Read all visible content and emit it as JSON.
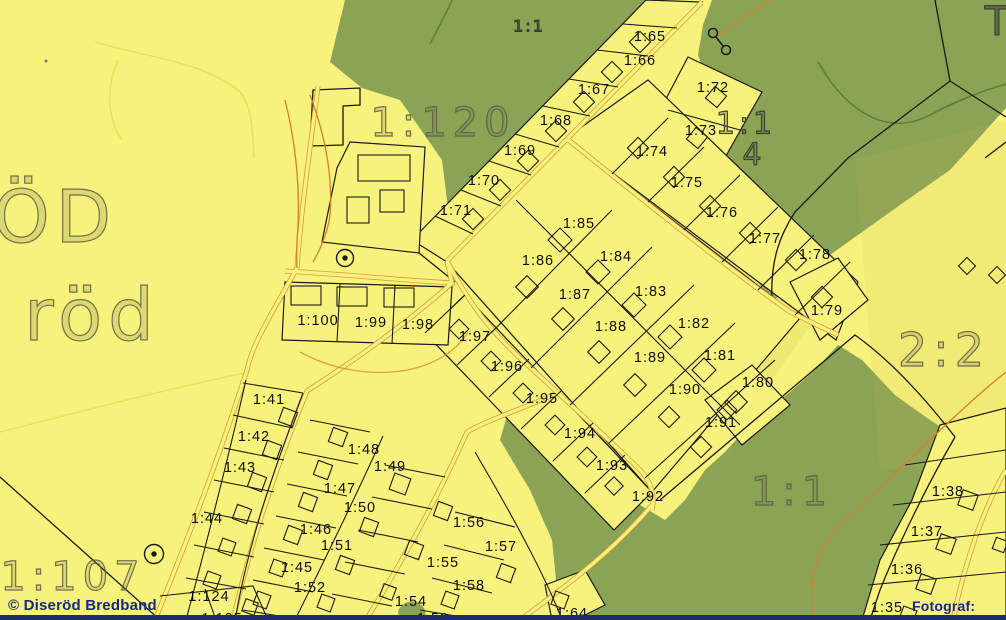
{
  "map": {
    "watermark": "© Diseröd Bredband",
    "credit": "Fotograf: DWG",
    "colors": {
      "background_yellow": "#f7f27b",
      "forest_green": "#8ba355",
      "road_orange": "#d89a3c",
      "contour_orange": "#d97e2e",
      "boundary_ink": "#1a1a1a",
      "big_label_gray": "#6f6f5a",
      "watermark_navy": "#16278f"
    },
    "area_labels": [
      {
        "text": "ÖD",
        "x": 55,
        "y": 217,
        "size": 72,
        "cls": "outline"
      },
      {
        "text": "röd",
        "x": 92,
        "y": 315,
        "size": 72,
        "cls": "outline"
      },
      {
        "text": "1:120",
        "x": 443,
        "y": 123,
        "size": 40,
        "cls": "outline"
      },
      {
        "text": "1:107",
        "x": 73,
        "y": 577,
        "size": 40,
        "cls": "outline"
      },
      {
        "text": "2:2",
        "x": 944,
        "y": 350,
        "size": 46,
        "cls": "outline"
      },
      {
        "text": "1:1",
        "x": 792,
        "y": 492,
        "size": 40,
        "cls": "outline"
      },
      {
        "text": "1:1",
        "x": 529,
        "y": 26,
        "size": 16,
        "cls": "dark"
      },
      {
        "text": "1:1",
        "x": 746,
        "y": 124,
        "size": 30,
        "cls": "outline-dark"
      },
      {
        "text": "4",
        "x": 754,
        "y": 155,
        "size": 30,
        "cls": "outline-dark"
      },
      {
        "text": "T",
        "x": 998,
        "y": 22,
        "size": 40,
        "cls": "dark"
      }
    ],
    "parcel_labels": [
      {
        "text": "1:65",
        "x": 650,
        "y": 37
      },
      {
        "text": "1:66",
        "x": 640,
        "y": 61
      },
      {
        "text": "1:67",
        "x": 594,
        "y": 90
      },
      {
        "text": "1:68",
        "x": 556,
        "y": 121
      },
      {
        "text": "1:69",
        "x": 520,
        "y": 151
      },
      {
        "text": "1:70",
        "x": 484,
        "y": 181
      },
      {
        "text": "1:71",
        "x": 456,
        "y": 211
      },
      {
        "text": "1:72",
        "x": 713,
        "y": 88
      },
      {
        "text": "1:73",
        "x": 701,
        "y": 131
      },
      {
        "text": "1:74",
        "x": 652,
        "y": 152
      },
      {
        "text": "1:75",
        "x": 687,
        "y": 183
      },
      {
        "text": "1:76",
        "x": 722,
        "y": 213
      },
      {
        "text": "1:77",
        "x": 765,
        "y": 239
      },
      {
        "text": "1:78",
        "x": 815,
        "y": 255
      },
      {
        "text": "1:79",
        "x": 827,
        "y": 311
      },
      {
        "text": "1:85",
        "x": 579,
        "y": 224
      },
      {
        "text": "1:84",
        "x": 616,
        "y": 257
      },
      {
        "text": "1:83",
        "x": 651,
        "y": 292
      },
      {
        "text": "1:82",
        "x": 694,
        "y": 324
      },
      {
        "text": "1:81",
        "x": 720,
        "y": 356
      },
      {
        "text": "1:86",
        "x": 538,
        "y": 261
      },
      {
        "text": "1:87",
        "x": 575,
        "y": 295
      },
      {
        "text": "1:88",
        "x": 611,
        "y": 327
      },
      {
        "text": "1:89",
        "x": 650,
        "y": 358
      },
      {
        "text": "1:90",
        "x": 685,
        "y": 390
      },
      {
        "text": "1:91",
        "x": 721,
        "y": 423
      },
      {
        "text": "1:80",
        "x": 758,
        "y": 383
      },
      {
        "text": "1:97",
        "x": 475,
        "y": 337
      },
      {
        "text": "1:96",
        "x": 507,
        "y": 367
      },
      {
        "text": "1:95",
        "x": 542,
        "y": 399
      },
      {
        "text": "1:94",
        "x": 580,
        "y": 434
      },
      {
        "text": "1:93",
        "x": 612,
        "y": 466
      },
      {
        "text": "1:92",
        "x": 648,
        "y": 497
      },
      {
        "text": "1:98",
        "x": 418,
        "y": 325
      },
      {
        "text": "1:99",
        "x": 371,
        "y": 323
      },
      {
        "text": "1:100",
        "x": 318,
        "y": 321
      },
      {
        "text": "1:41",
        "x": 269,
        "y": 400
      },
      {
        "text": "1:42",
        "x": 254,
        "y": 437
      },
      {
        "text": "1:43",
        "x": 240,
        "y": 468
      },
      {
        "text": "1:44",
        "x": 207,
        "y": 519
      },
      {
        "text": "1:45",
        "x": 297,
        "y": 568
      },
      {
        "text": "1:46",
        "x": 316,
        "y": 530
      },
      {
        "text": "1:47",
        "x": 340,
        "y": 489
      },
      {
        "text": "1:48",
        "x": 364,
        "y": 450
      },
      {
        "text": "1:49",
        "x": 390,
        "y": 467
      },
      {
        "text": "1:50",
        "x": 360,
        "y": 508
      },
      {
        "text": "1:51",
        "x": 337,
        "y": 546
      },
      {
        "text": "1:52",
        "x": 310,
        "y": 588
      },
      {
        "text": "1:124",
        "x": 209,
        "y": 597
      },
      {
        "text": "1:125",
        "x": 222,
        "y": 619
      },
      {
        "text": "1:54",
        "x": 411,
        "y": 602
      },
      {
        "text": "1:55",
        "x": 443,
        "y": 563
      },
      {
        "text": "1:56",
        "x": 469,
        "y": 523
      },
      {
        "text": "1:57",
        "x": 501,
        "y": 547
      },
      {
        "text": "1:58",
        "x": 469,
        "y": 586
      },
      {
        "text": "1:59",
        "x": 433,
        "y": 619
      },
      {
        "text": "1:64",
        "x": 572,
        "y": 614
      },
      {
        "text": "1:35",
        "x": 887,
        "y": 608
      },
      {
        "text": "1:36",
        "x": 907,
        "y": 570
      },
      {
        "text": "1:37",
        "x": 927,
        "y": 532
      },
      {
        "text": "1:38",
        "x": 948,
        "y": 492
      }
    ]
  }
}
